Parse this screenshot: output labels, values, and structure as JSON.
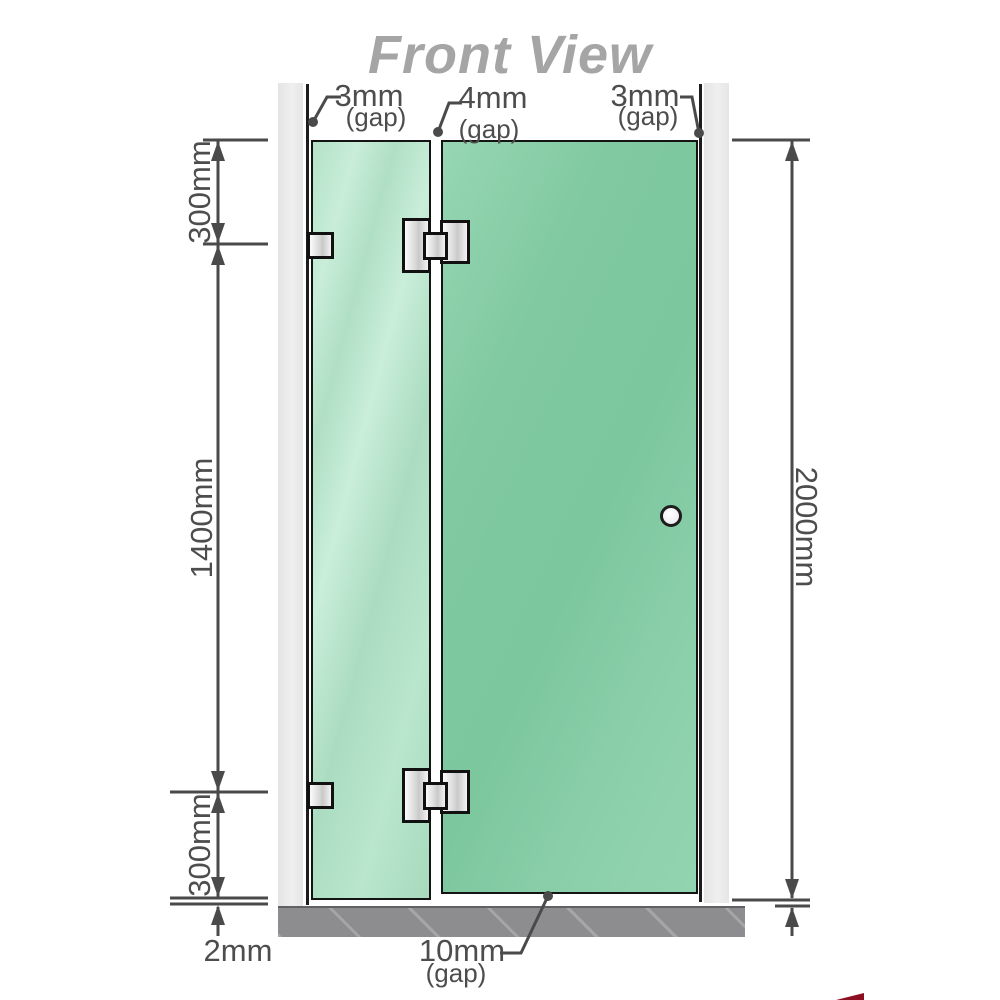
{
  "title": "Front View",
  "labels": {
    "gap_top_left": {
      "value": "3mm",
      "qualifier": "(gap)"
    },
    "gap_top_middle": {
      "value": "4mm",
      "qualifier": "(gap)"
    },
    "gap_top_right": {
      "value": "3mm",
      "qualifier": "(gap)"
    },
    "segment_top": "300mm",
    "segment_middle": "1400mm",
    "segment_bottom": "300mm",
    "floor_clearance": "2mm",
    "total_height": "2000mm",
    "gap_bottom": {
      "value": "10mm",
      "qualifier": "(gap)"
    }
  },
  "colors": {
    "glass_fixed_panel": "#b5e2c9",
    "glass_door_panel": "#82caa3",
    "wall": "#e9e9e9",
    "floor": "#8d8d8f",
    "dimension_lines": "#4a4a4a",
    "label_text": "#4d4d4d",
    "title_text": "#a5a5a5",
    "hardware": "#e0e0e0",
    "watermark": "#8c1022"
  }
}
